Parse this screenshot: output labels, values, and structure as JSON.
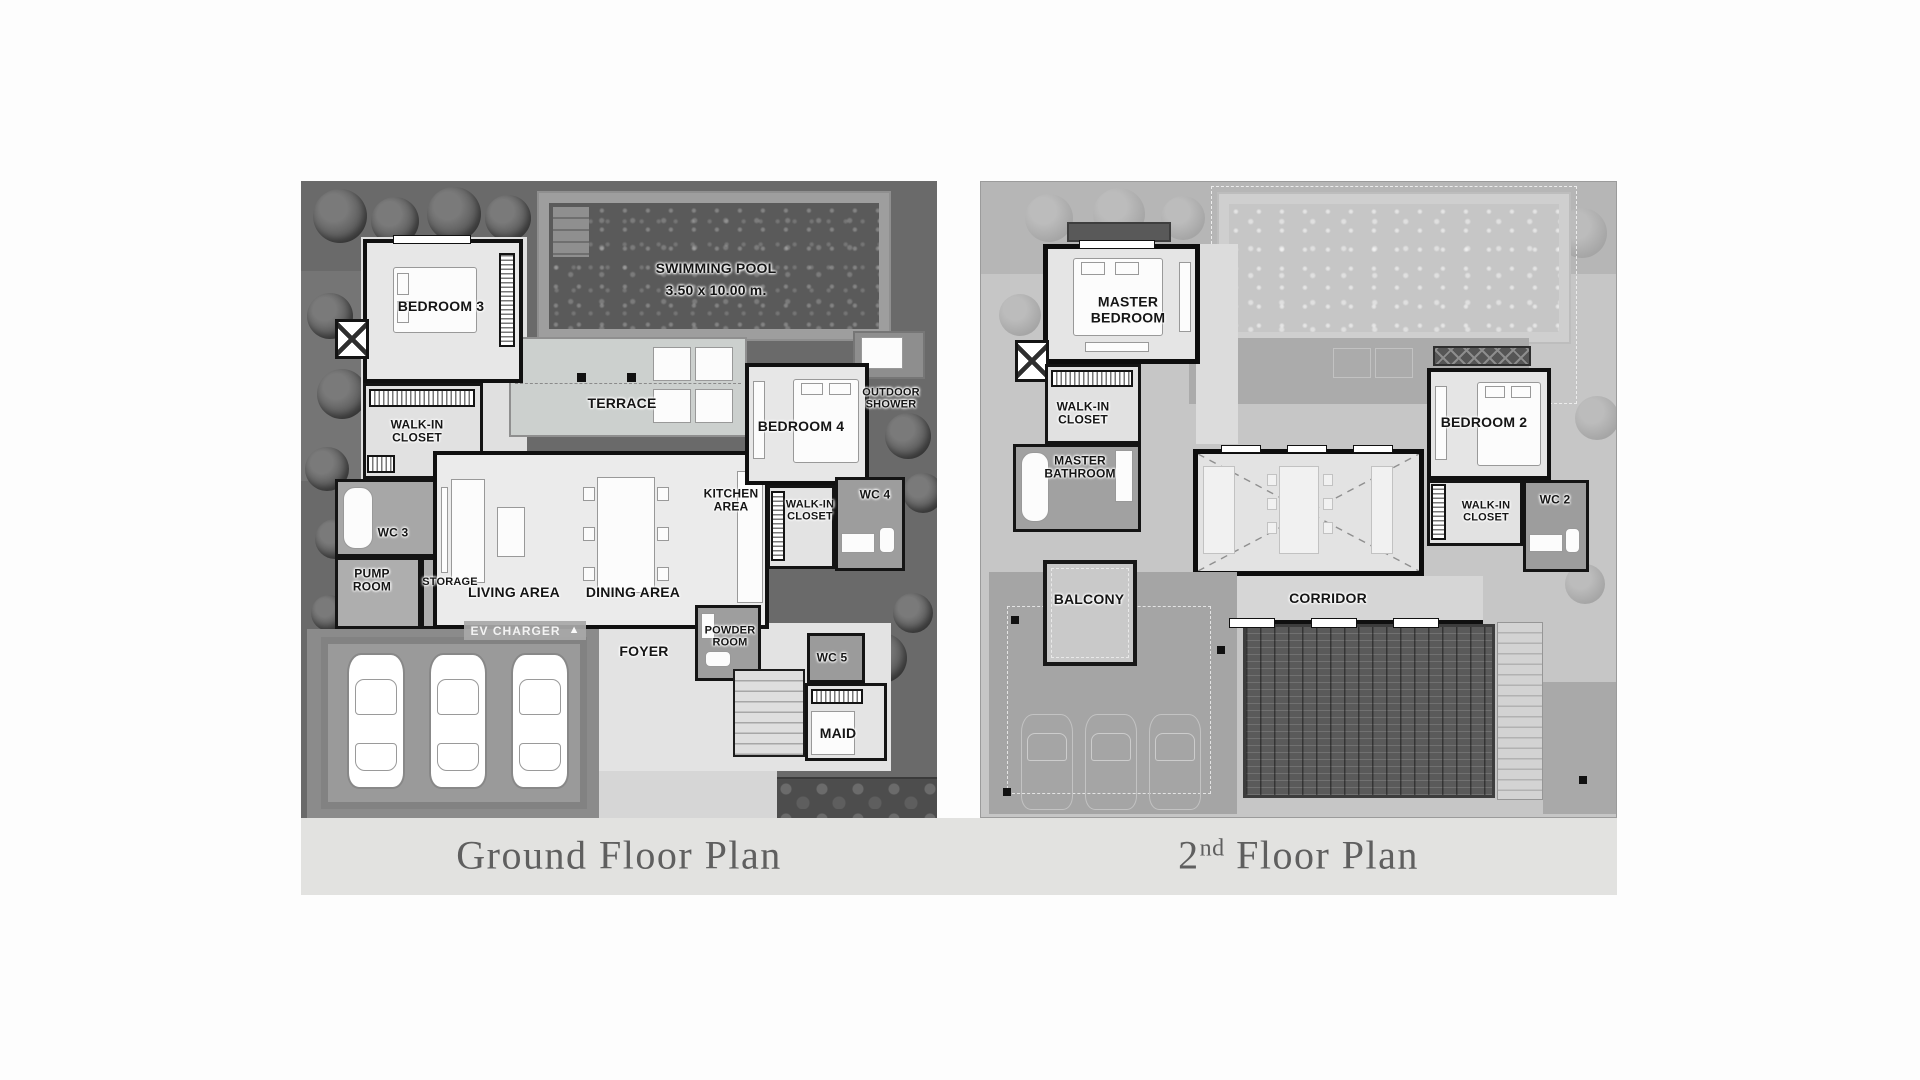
{
  "captions": {
    "ground": "Ground Floor Plan",
    "second_number": "2",
    "second_ordinal": "nd",
    "second_rest": " Floor Plan"
  },
  "ground_floor": {
    "swimming_pool": "SWIMMING POOL",
    "swimming_pool_size": "3.50 x 10.00 m.",
    "bedroom_3": "BEDROOM 3",
    "walk_in_closet_1": "WALK-IN CLOSET",
    "terrace": "TERRACE",
    "bedroom_4": "BEDROOM 4",
    "outdoor_shower": "OUTDOOR SHOWER",
    "kitchen_area": "KITCHEN AREA",
    "walk_in_closet_2": "WALK-IN CLOSET",
    "wc_4": "WC 4",
    "wc_3": "WC 3",
    "pump_room": "PUMP ROOM",
    "storage": "STORAGE",
    "living_area": "LIVING AREA",
    "dining_area": "DINING AREA",
    "ev_charger": "EV CHARGER",
    "foyer": "FOYER",
    "powder_room": "POWDER ROOM",
    "wc_5": "WC 5",
    "maid": "MAID"
  },
  "second_floor": {
    "master_bedroom": "MASTER BEDROOM",
    "walk_in_closet_master": "WALK-IN CLOSET",
    "master_bathroom": "MASTER BATHROOM",
    "bedroom_2": "BEDROOM 2",
    "walk_in_closet_2": "WALK-IN CLOSET",
    "wc_2": "WC 2",
    "balcony": "BALCONY",
    "corridor": "CORRIDOR"
  },
  "icons": {
    "ev_charger_arrow": "▲"
  },
  "colors": {
    "wall": "#101010",
    "garden": "#6a6a6a",
    "pool_water": "#5a5a5a",
    "floor_light": "#e7e7e7",
    "floor_wet": "#9d9d9d",
    "ghost_base": "#c6c6c6",
    "caption_bg": "#e2e2e0",
    "caption_text": "#5f5f5f",
    "label_text": "#151515"
  }
}
